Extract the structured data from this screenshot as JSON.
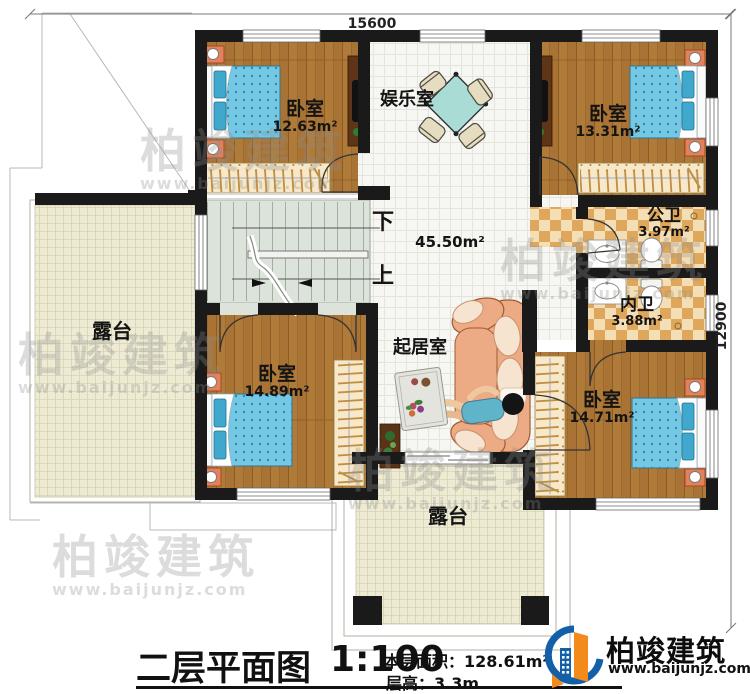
{
  "dimensions": {
    "top": "15600",
    "right": "12900"
  },
  "rooms": {
    "bedroom_top_left": {
      "name": "卧室",
      "area": "12.63m²"
    },
    "entertainment": {
      "name": "娱乐室"
    },
    "bedroom_top_right": {
      "name": "卧室",
      "area": "13.31m²"
    },
    "hall": {
      "area": "45.50m²"
    },
    "stairs": {
      "down": "下",
      "up": "上"
    },
    "public_bath": {
      "name": "公卫",
      "area": "3.97m²"
    },
    "private_bath": {
      "name": "内卫",
      "area": "3.88m²"
    },
    "living": {
      "name": "起居室"
    },
    "bedroom_bottom_left": {
      "name": "卧室",
      "area": "14.89m²"
    },
    "bedroom_bottom_right": {
      "name": "卧室",
      "area": "14.71m²"
    },
    "terrace_left": {
      "name": "露台"
    },
    "terrace_bottom": {
      "name": "露台"
    }
  },
  "title_block": {
    "title": "二层平面图",
    "scale": "1:100",
    "floor_area_label": "本层面积：",
    "floor_area_value": "128.61m²",
    "floor_height_label": "层高：",
    "floor_height_value": "3.3m"
  },
  "logo": {
    "company": "柏竣建筑",
    "website": "www.baijunjz.com"
  },
  "watermark": {
    "text": "柏竣建筑",
    "url": "www.baijunjz.com"
  },
  "colors": {
    "wall": "#1a1a1a",
    "wood_floor": "#b07b39",
    "hall_tile": "#f6f6f2",
    "terrace_tile": "#eeebd5",
    "bath_checker": "#dfa75c",
    "stair_floor": "#dce3da",
    "bed_blue": "#74c8e4",
    "logo_blue": "#1360a8",
    "logo_orange": "#f28a1c"
  }
}
